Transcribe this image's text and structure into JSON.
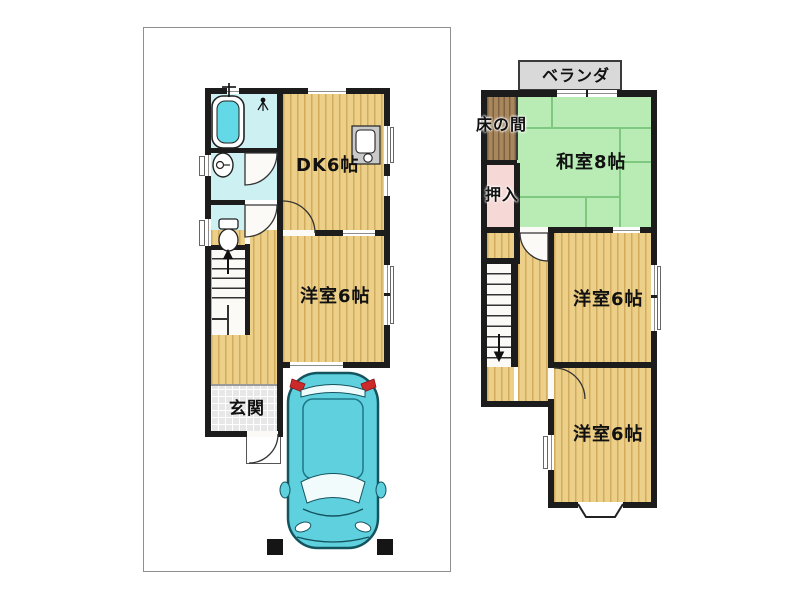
{
  "floor1": {
    "rooms": {
      "dk": {
        "label": "DK6帖"
      },
      "western": {
        "label": "洋室6帖"
      },
      "entrance": {
        "label": "玄関"
      }
    },
    "stairs_direction": "up",
    "fixtures": [
      "bathtub",
      "shower",
      "washbasin",
      "toilet",
      "kitchen-sink",
      "staircase",
      "entrance-porch",
      "car",
      "gate-posts"
    ]
  },
  "floor2": {
    "rooms": {
      "veranda": {
        "label": "ベランダ"
      },
      "tokonoma": {
        "label": "床の間"
      },
      "washitsu": {
        "label": "和室8帖"
      },
      "oshiire": {
        "label": "押入"
      },
      "western_middle": {
        "label": "洋室6帖"
      },
      "western_bottom": {
        "label": "洋室6帖"
      }
    },
    "stairs_direction": "down",
    "fixtures": [
      "staircase",
      "bay-window",
      "veranda-deck"
    ]
  },
  "colors": {
    "wall": "#1c1c1c",
    "wood_floor": "#ecd089",
    "wood_stripe": "#d2ab5c",
    "tatami_green": "#b9ecb5",
    "tatami_line": "#7fc87f",
    "closet_pink": "#f6d9d7",
    "tokonoma_brown": "#a8875c",
    "veranda_gray": "#d9d9d9",
    "bathroom_cyan": "#cdf0f3",
    "bathtub_cyan": "#63d8e6",
    "entrance_tile": "#e7e7e7",
    "car_teal": "#5fd0de",
    "taillight_red": "#cc2a2a"
  }
}
